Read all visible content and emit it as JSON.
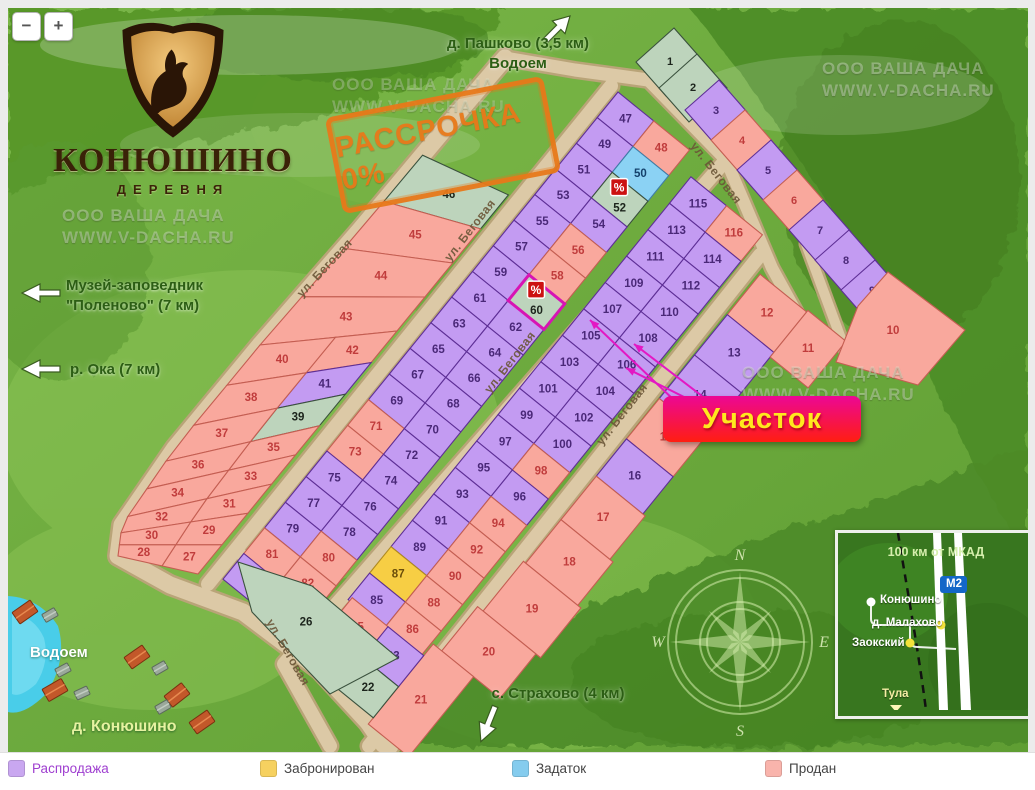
{
  "zoom_controls": {
    "minus": "−",
    "plus": "+"
  },
  "logo": {
    "title": "КОНЮШИНО",
    "subtitle": "ДЕРЕВНЯ"
  },
  "stamp": {
    "text": "РАССРОЧКА 0%",
    "color": "#e8791a"
  },
  "watermark": {
    "line1": "ООО ВАША ДАЧА",
    "line2": "WWW.V-DACHA.RU"
  },
  "directions": {
    "pashkovo_line1": "д. Пашково (3,5 км)",
    "pashkovo_line2": "Водоем",
    "polenovo_line1": "Музей-заповедник",
    "polenovo_line2": "\"Поленово\" (7 км)",
    "oka": "р. Ока (7 км)",
    "strahovo": "с. Страхово (4 км)",
    "vodoem": "Водоем",
    "konyushino_village": "д. Конюшино"
  },
  "callout": {
    "text": "Участок",
    "bg_top": "#ec0795",
    "bg_bottom": "#ff1e11",
    "text_color": "#ffe81e"
  },
  "map": {
    "street_name": "ул. Беговая",
    "badge": "%",
    "selected_plot": "60",
    "plot_badges": [
      "52",
      "60"
    ],
    "compass_letters": [
      "N",
      "E",
      "S",
      "W"
    ],
    "statuses": {
      "1": "green",
      "2": "green",
      "3": "sale",
      "4": "sold",
      "5": "sale",
      "6": "sold",
      "7": "sale",
      "8": "sale",
      "9": "sale",
      "10": "sold",
      "11": "sold",
      "12": "sold",
      "13": "sale",
      "14": "sale",
      "15": "sold",
      "16": "sale",
      "17": "sold",
      "18": "sold",
      "19": "sold",
      "20": "sold",
      "21": "sold",
      "22": "green",
      "23": "sale",
      "24": "sold",
      "25": "sold",
      "26": "green",
      "27": "sold",
      "28": "sold",
      "29": "sold",
      "30": "sold",
      "31": "sold",
      "32": "sold",
      "33": "sold",
      "34": "sold",
      "35": "sold",
      "36": "sold",
      "37": "sold",
      "38": "sold",
      "39": "green",
      "40": "sold",
      "41": "sale",
      "42": "sold",
      "43": "sold",
      "44": "sold",
      "45": "sold",
      "46": "green",
      "47": "sale",
      "48": "sold",
      "49": "sale",
      "50": "deposit",
      "51": "sale",
      "52": "green",
      "53": "sale",
      "54": "sale",
      "55": "sale",
      "56": "sold",
      "57": "sale",
      "58": "sold",
      "59": "sale",
      "60": "green",
      "61": "sale",
      "62": "sale",
      "63": "sale",
      "64": "sale",
      "65": "sale",
      "66": "sale",
      "67": "sale",
      "68": "sale",
      "69": "sale",
      "70": "sale",
      "71": "sold",
      "72": "sale",
      "73": "sold",
      "74": "sale",
      "75": "sale",
      "76": "sale",
      "77": "sale",
      "78": "sale",
      "79": "sale",
      "80": "sold",
      "81": "sold",
      "82": "sold",
      "83": "sale",
      "84": "sale",
      "85": "sale",
      "86": "sold",
      "87": "reserved",
      "88": "sold",
      "89": "sale",
      "90": "sold",
      "91": "sale",
      "92": "sold",
      "93": "sale",
      "94": "sold",
      "95": "sale",
      "96": "sale",
      "97": "sale",
      "98": "sold",
      "99": "sale",
      "100": "sale",
      "101": "sale",
      "102": "sale",
      "103": "sale",
      "104": "sale",
      "105": "sale",
      "106": "sale",
      "107": "sale",
      "108": "sale",
      "109": "sale",
      "110": "sale",
      "111": "sale",
      "112": "sale",
      "113": "sale",
      "114": "sale",
      "115": "sale",
      "116": "sold"
    }
  },
  "status_colors": {
    "sale": "#c39bf2",
    "sold": "#f9a89d",
    "reserved": "#f7ce44",
    "deposit": "#8bd2f4",
    "green": "#bdd4bc"
  },
  "inset": {
    "title": "100 км от МКАД",
    "road_badge": "М2",
    "towns": [
      {
        "name": "Конюшино"
      },
      {
        "name": "д. Малахово"
      },
      {
        "name": "Заокский"
      },
      {
        "name": "Тула"
      }
    ]
  },
  "legend": {
    "row1": [
      {
        "label": "Распродажа",
        "color": "#c9a7f0",
        "label_color": "#9f3fd0"
      },
      {
        "label": "Забронирован",
        "color": "#f6d160",
        "label_color": "#444444"
      },
      {
        "label": "Задаток",
        "color": "#85ccee",
        "label_color": "#444444"
      },
      {
        "label": "Продан",
        "color": "#f9b4ac",
        "label_color": "#444444"
      }
    ],
    "row2_colors": [
      "#9fdf9f",
      "#d4f0d4",
      "#aec6ae",
      "#2e7d32"
    ]
  }
}
